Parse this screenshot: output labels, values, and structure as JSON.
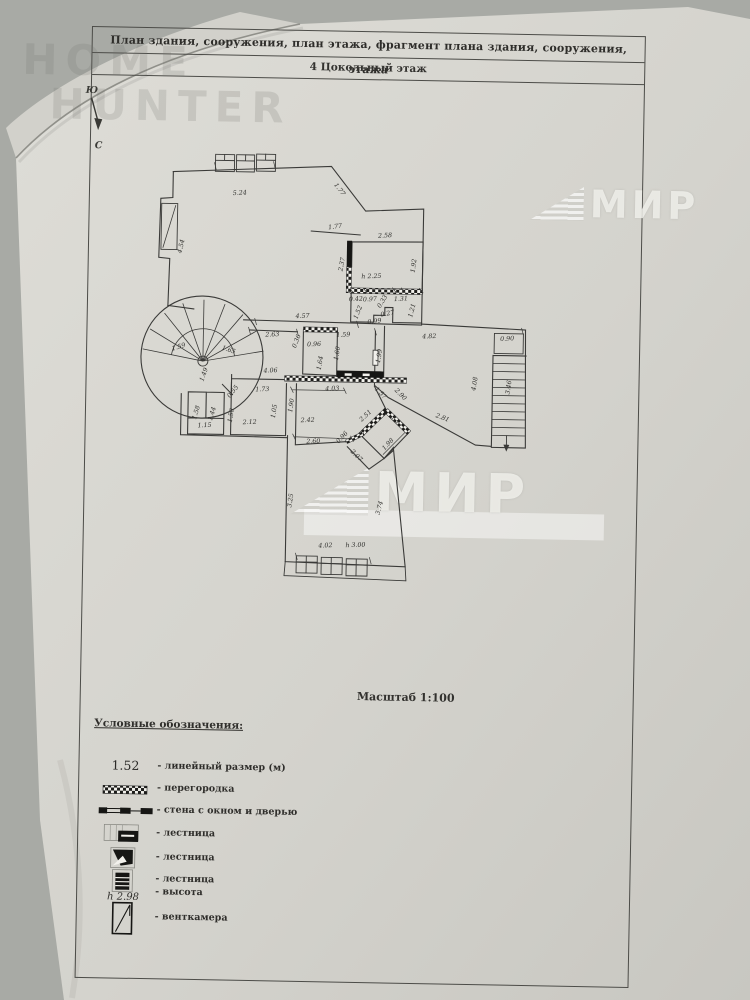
{
  "document": {
    "header_line1": "План здания, сооружения, план этажа, фрагмент плана здания, сооружения, этажа",
    "header_line2": "4 Цокольный этаж",
    "scale_label": "Масштаб 1:100"
  },
  "compass": {
    "south_label": "Ю",
    "north_label": "С"
  },
  "watermarks": {
    "home_line1": "HOME",
    "home_line2": "HUNTER",
    "mir_text": "МИР"
  },
  "legend": {
    "title": "Условные обозначения:",
    "items": [
      {
        "symbol": "linear-dimension",
        "sample": "1.52",
        "label": "- линейный размер (м)"
      },
      {
        "symbol": "partition",
        "label": "- перегородка"
      },
      {
        "symbol": "wall-window-door",
        "label": "- стена с окном и дверью"
      },
      {
        "symbol": "stairs",
        "label": "- лестница"
      },
      {
        "symbol": "stairs",
        "label": "- лестница"
      },
      {
        "symbol": "stairs",
        "label": "- лестница"
      },
      {
        "symbol": "height",
        "sample": "h 2.98",
        "label": "- высота"
      },
      {
        "symbol": "vent-chamber",
        "label": "- венткамера"
      }
    ]
  },
  "plan": {
    "dimensions": [
      {
        "t": "5.24",
        "x": 100,
        "y": 52,
        "r": -4
      },
      {
        "t": "1.77",
        "x": 198,
        "y": 46,
        "r": 52
      },
      {
        "t": "1.77",
        "x": 196,
        "y": 84,
        "r": -8
      },
      {
        "t": "4.54",
        "x": 44,
        "y": 105,
        "r": -78
      },
      {
        "t": "2.58",
        "x": 246,
        "y": 92,
        "r": -4
      },
      {
        "t": "1.92",
        "x": 277,
        "y": 120,
        "r": -84
      },
      {
        "t": "h 2.25",
        "x": 233,
        "y": 133,
        "r": -3
      },
      {
        "t": "2.37",
        "x": 205,
        "y": 120,
        "r": -80
      },
      {
        "t": "0.42",
        "x": 218,
        "y": 156,
        "r": -4
      },
      {
        "t": "0.97",
        "x": 232,
        "y": 156,
        "r": -4
      },
      {
        "t": "0.33",
        "x": 246,
        "y": 157,
        "r": -60
      },
      {
        "t": "1.31",
        "x": 263,
        "y": 155,
        "r": -4
      },
      {
        "t": "1.52",
        "x": 222,
        "y": 168,
        "r": -70
      },
      {
        "t": "1.21",
        "x": 276,
        "y": 165,
        "r": -76
      },
      {
        "t": "0.99",
        "x": 237,
        "y": 178,
        "r": -8
      },
      {
        "t": "0.27",
        "x": 250,
        "y": 170,
        "r": -12
      },
      {
        "t": "4.57",
        "x": 165,
        "y": 174,
        "r": -3
      },
      {
        "t": "2.63",
        "x": 135,
        "y": 193,
        "r": -3
      },
      {
        "t": "0.36",
        "x": 161,
        "y": 198,
        "r": -70
      },
      {
        "t": "0.96",
        "x": 177,
        "y": 202,
        "r": -3
      },
      {
        "t": "1.59",
        "x": 206,
        "y": 192,
        "r": -3
      },
      {
        "t": "1.60",
        "x": 202,
        "y": 209,
        "r": -82
      },
      {
        "t": "1.64",
        "x": 185,
        "y": 219,
        "r": -82
      },
      {
        "t": "1.99",
        "x": 244,
        "y": 211,
        "r": -82
      },
      {
        "t": "4.82",
        "x": 292,
        "y": 192,
        "r": -3
      },
      {
        "t": "0.90",
        "x": 370,
        "y": 193,
        "r": -4
      },
      {
        "t": "4.08",
        "x": 340,
        "y": 237,
        "r": -82
      },
      {
        "t": "3.46",
        "x": 374,
        "y": 240,
        "r": -82
      },
      {
        "t": "1.59",
        "x": 42,
        "y": 207,
        "r": -18
      },
      {
        "t": "1.65",
        "x": 91,
        "y": 209,
        "r": 18
      },
      {
        "t": "1.49",
        "x": 69,
        "y": 233,
        "r": -72
      },
      {
        "t": "4.06",
        "x": 134,
        "y": 229,
        "r": -3
      },
      {
        "t": "4.03",
        "x": 196,
        "y": 246,
        "r": -3
      },
      {
        "t": "0.55",
        "x": 98,
        "y": 250,
        "r": -52
      },
      {
        "t": "1.73",
        "x": 126,
        "y": 248,
        "r": -3
      },
      {
        "t": "1.05",
        "x": 140,
        "y": 268,
        "r": -82
      },
      {
        "t": "1.90",
        "x": 157,
        "y": 262,
        "r": -82
      },
      {
        "t": "1.50",
        "x": 97,
        "y": 273,
        "r": -82
      },
      {
        "t": "1.58",
        "x": 62,
        "y": 271,
        "r": -74
      },
      {
        "t": "1.44",
        "x": 78,
        "y": 272,
        "r": -74
      },
      {
        "t": "1.15",
        "x": 69,
        "y": 285,
        "r": -3
      },
      {
        "t": "2.12",
        "x": 114,
        "y": 281,
        "r": -3
      },
      {
        "t": "2.42",
        "x": 172,
        "y": 278,
        "r": -3
      },
      {
        "t": "2.60",
        "x": 178,
        "y": 299,
        "r": -3
      },
      {
        "t": "0.96",
        "x": 208,
        "y": 294,
        "r": -48
      },
      {
        "t": "2.51",
        "x": 231,
        "y": 272,
        "r": -44
      },
      {
        "t": "1.17",
        "x": 260,
        "y": 277,
        "r": 44
      },
      {
        "t": "1.98",
        "x": 254,
        "y": 300,
        "r": -48
      },
      {
        "t": "2.07",
        "x": 220,
        "y": 312,
        "r": 44
      },
      {
        "t": "2.90",
        "x": 263,
        "y": 250,
        "r": 44
      },
      {
        "t": "1.57",
        "x": 243,
        "y": 249,
        "r": 44
      },
      {
        "t": "2.81",
        "x": 306,
        "y": 273,
        "r": 20
      },
      {
        "t": "3.25",
        "x": 158,
        "y": 357,
        "r": -82
      },
      {
        "t": "3.74",
        "x": 247,
        "y": 363,
        "r": -76
      },
      {
        "t": "4.02",
        "x": 192,
        "y": 403,
        "r": -3
      },
      {
        "t": "h 3.00",
        "x": 222,
        "y": 402,
        "r": -3
      }
    ]
  }
}
